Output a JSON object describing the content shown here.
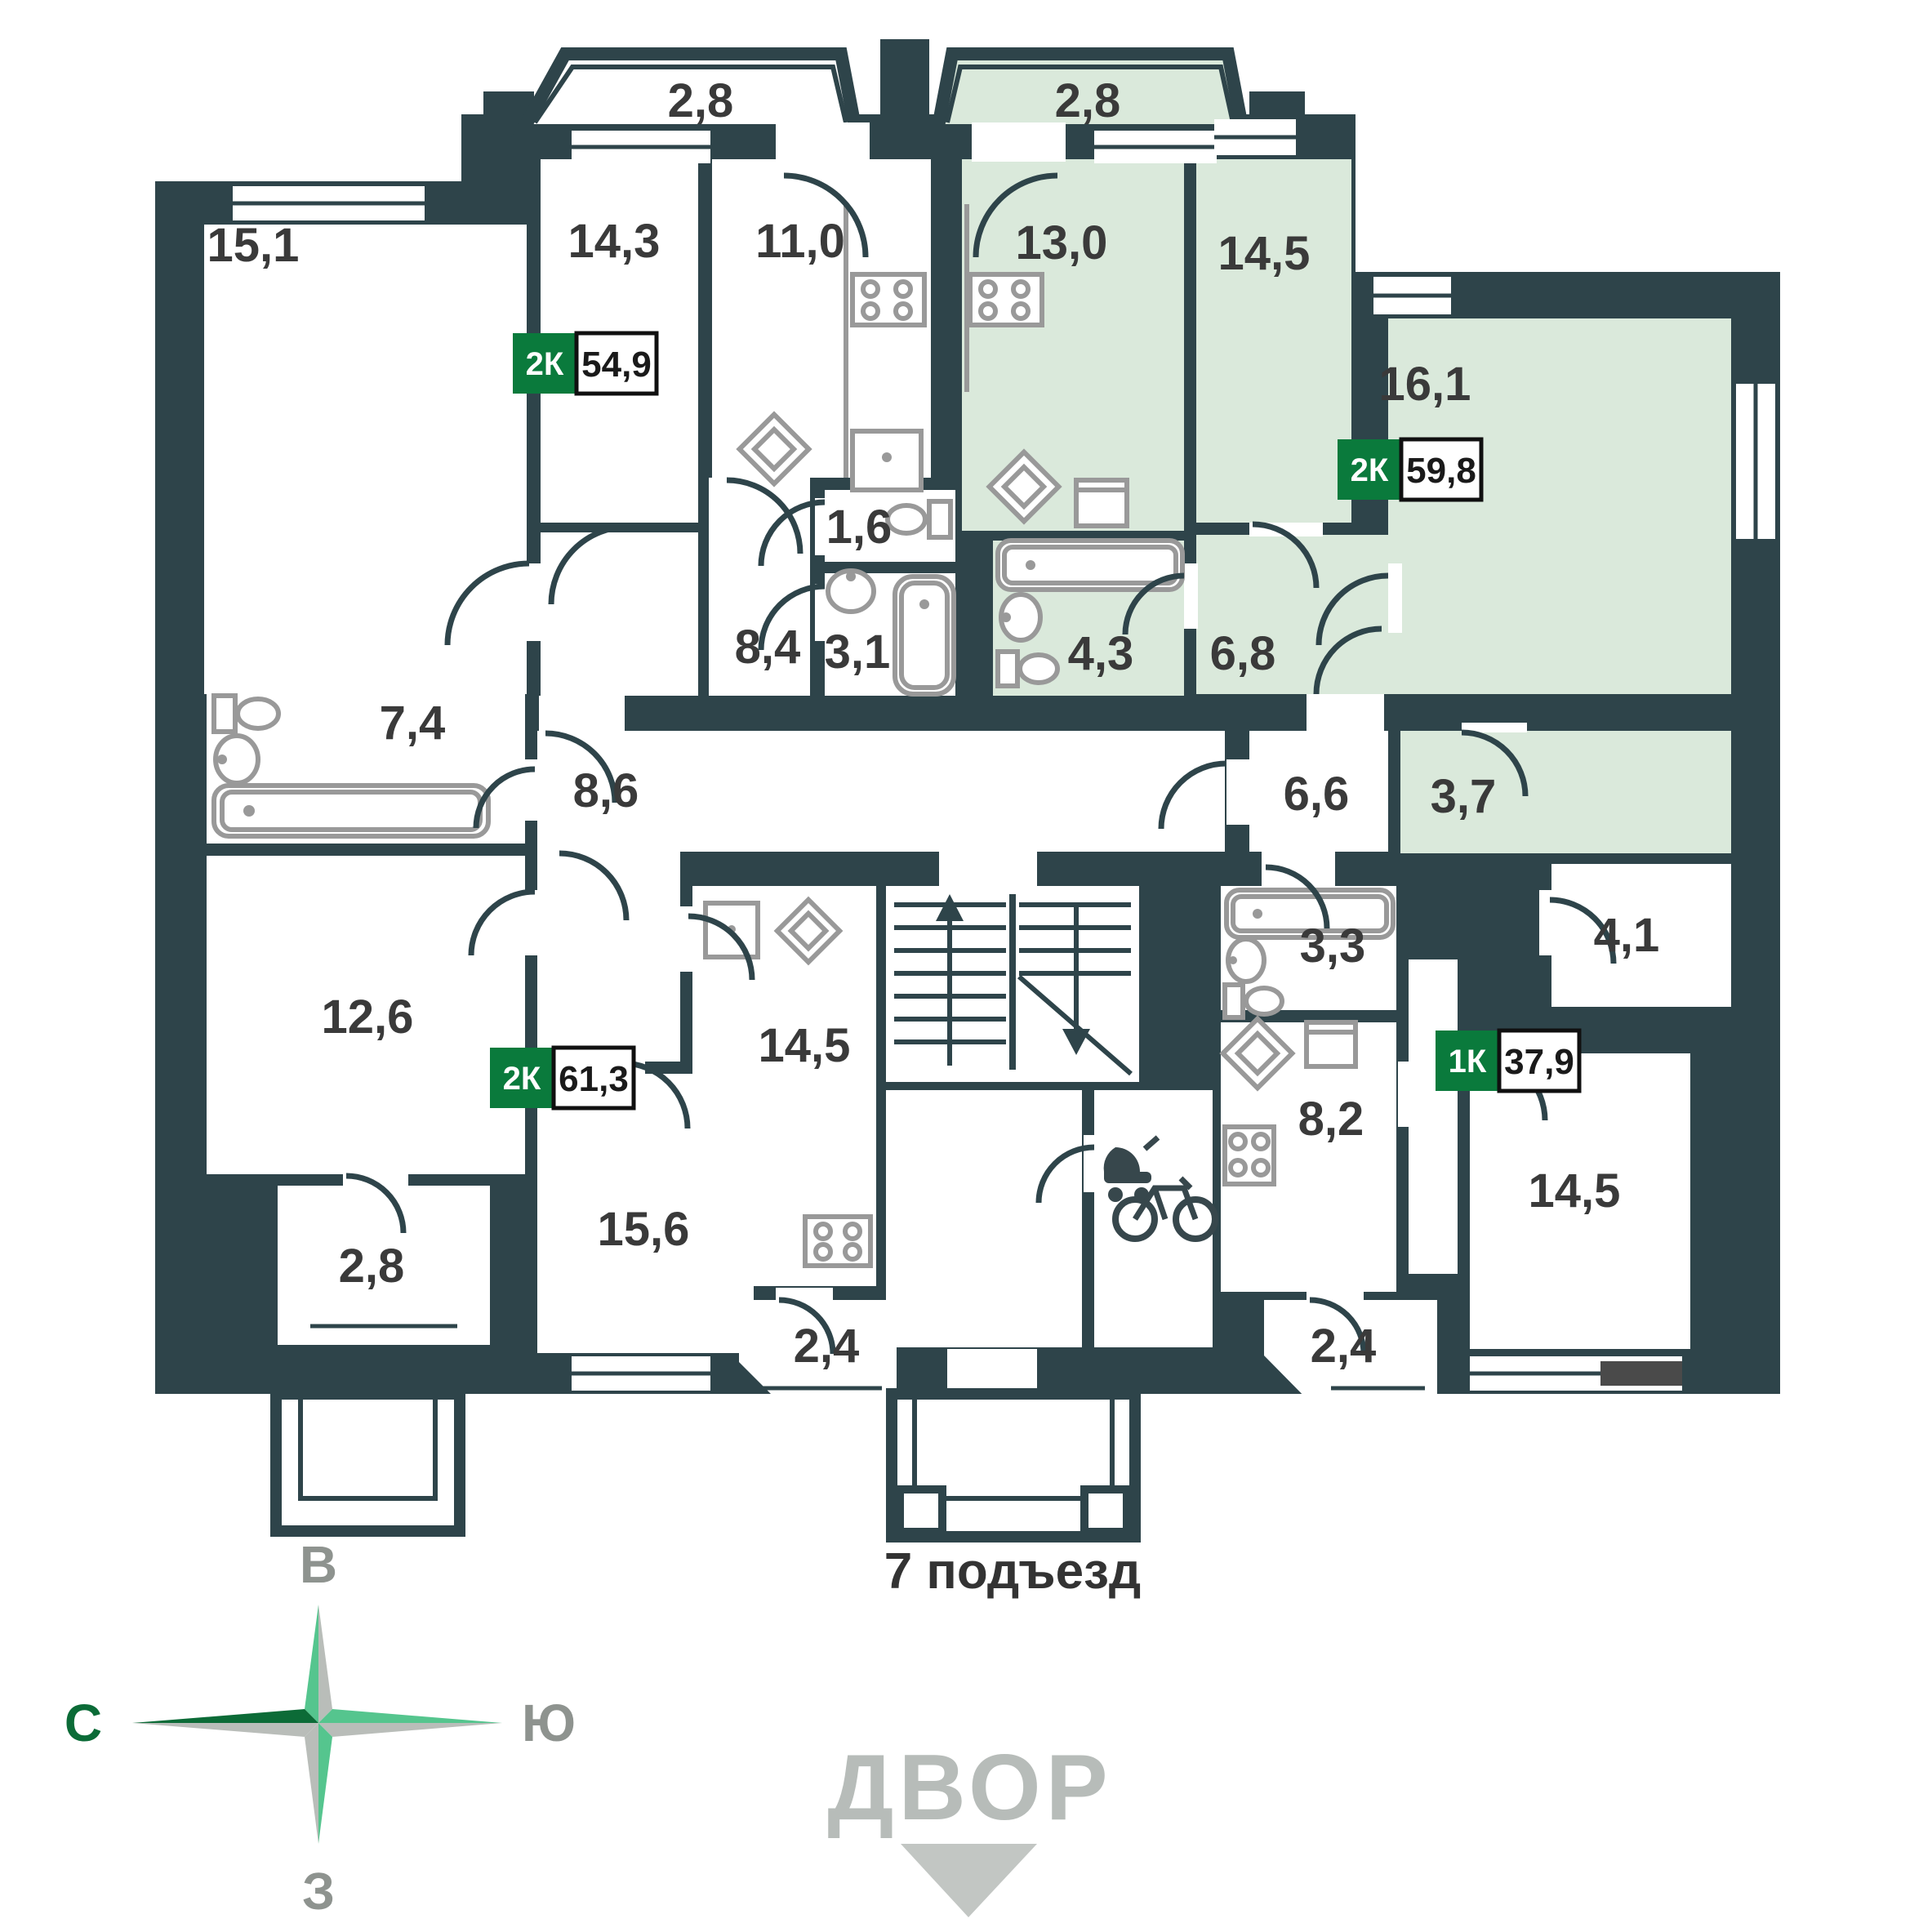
{
  "plan": {
    "entrance_label": "7 подъезд",
    "yard_label": "ДВОР",
    "compass": {
      "north": "С",
      "east": "В",
      "south": "Ю",
      "west": "З"
    },
    "rooms": {
      "bay_left": "2,8",
      "bay_right": "2,8",
      "r15_1": "15,1",
      "r14_3": "14,3",
      "r11_0": "11,0",
      "r13_0": "13,0",
      "r14_5_top": "14,5",
      "r16_1": "16,1",
      "r1_6": "1,6",
      "r8_4": "8,4",
      "r3_1": "3,1",
      "r4_3": "4,3",
      "r6_8": "6,8",
      "r7_4": "7,4",
      "r8_6": "8,6",
      "r6_6": "6,6",
      "r3_7": "3,7",
      "r12_6": "12,6",
      "r14_5_mid": "14,5",
      "r3_3": "3,3",
      "r8_2": "8,2",
      "r4_1": "4,1",
      "r2_8_loggia": "2,8",
      "r15_6": "15,6",
      "r2_4_left": "2,4",
      "r2_4_right": "2,4",
      "r14_5_bottom": "14,5"
    },
    "apartments": [
      {
        "type": "2К",
        "area": "54,9"
      },
      {
        "type": "2К",
        "area": "59,8"
      },
      {
        "type": "2К",
        "area": "61,3"
      },
      {
        "type": "1К",
        "area": "37,9"
      }
    ],
    "colors": {
      "wall": "#2E444A",
      "highlight": "#DAE9DB",
      "badge_green": "#0A7A3C"
    }
  }
}
